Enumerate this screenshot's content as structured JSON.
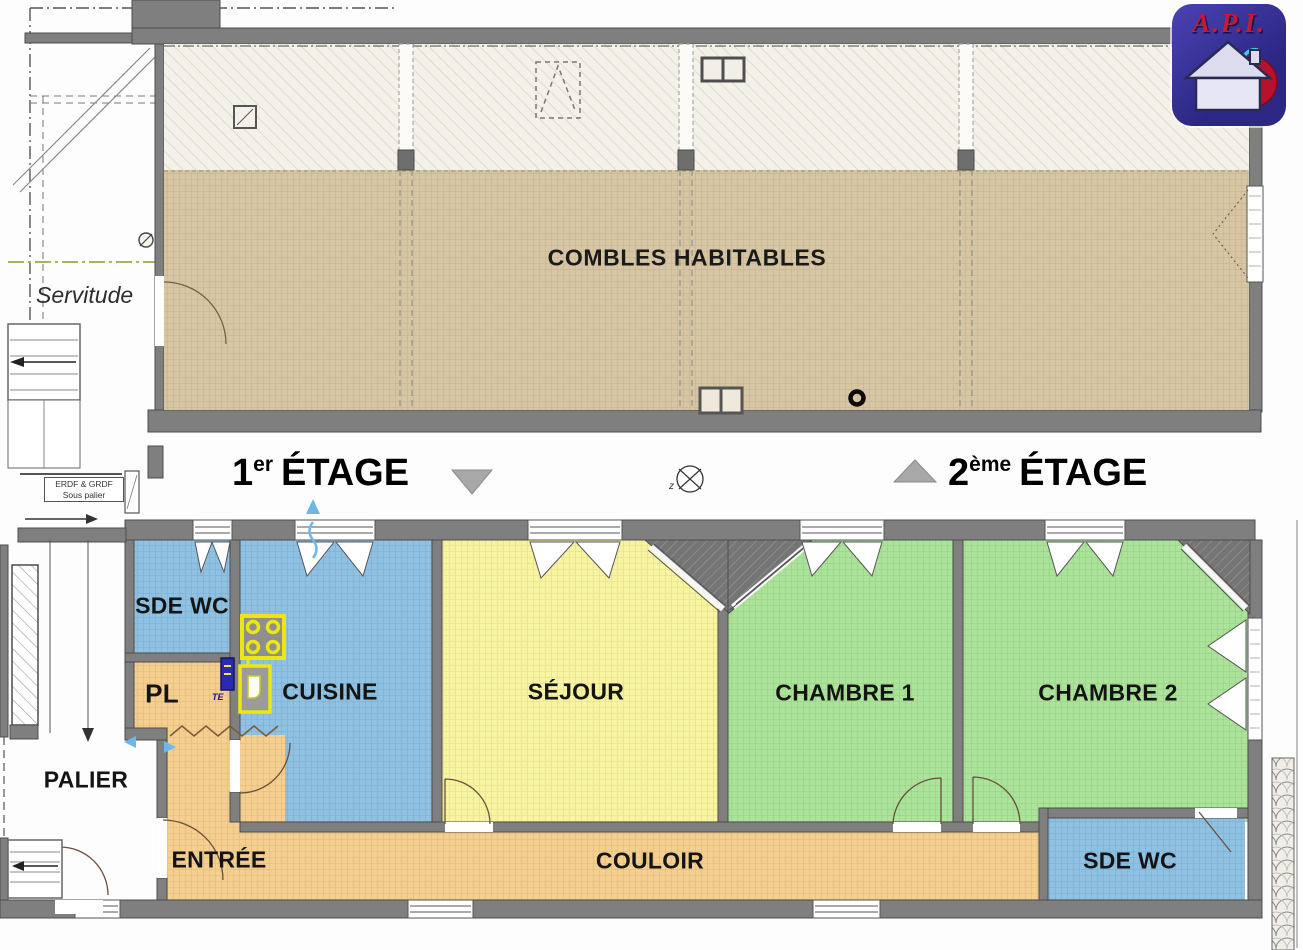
{
  "logo": {
    "label": "A.P.I."
  },
  "upper_plan": {
    "room_label": "COMBLES HABITABLES",
    "servitude": "Servitude"
  },
  "levels": {
    "first": {
      "num": "1",
      "sup": "er",
      "word": "ÉTAGE"
    },
    "second": {
      "num": "2",
      "sup": "ème",
      "word": "ÉTAGE"
    },
    "erdf": {
      "line1": "ERDF & GRDF",
      "line2": "Sous palier"
    },
    "compass": "z"
  },
  "rooms": {
    "sde_wc_top": "SDE WC",
    "pl": "PL",
    "cuisine": "CUISINE",
    "sejour": "SÉJOUR",
    "chambre1": "CHAMBRE 1",
    "chambre2": "CHAMBRE 2",
    "palier": "PALIER",
    "entree": "ENTRÉE",
    "couloir": "COULOIR",
    "sde_wc_bottom": "SDE WC",
    "te": "TE"
  },
  "colors": {
    "wall_gray": "#7f7f7f",
    "combles_tan": "#d7c6a4",
    "roof_hatch_cream": "#f4f1ea",
    "room_blue": "#8fc2e2",
    "room_yellow": "#f7f4a2",
    "room_green": "#ace39a",
    "room_orange": "#f4cf90",
    "logo_blue": "#2c2784",
    "logo_red": "#c41a33",
    "flow_arrow_blue": "#6fb7e8",
    "kitchen_yellow": "#ece80f",
    "axis_green": "#aab45e"
  }
}
